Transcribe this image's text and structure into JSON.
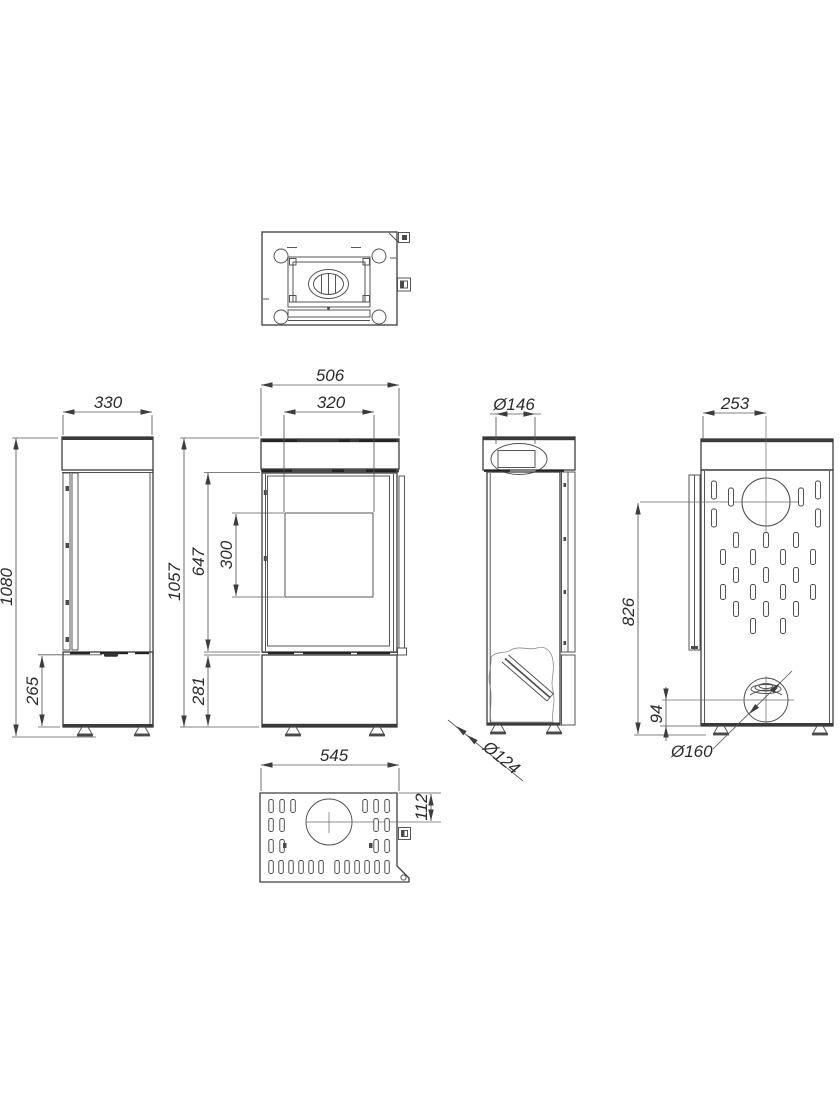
{
  "drawing": {
    "dimensions": {
      "front": {
        "width": "506",
        "glass_width": "320",
        "overall_height": "1057",
        "firebox_height": "647",
        "glass_height": "300",
        "base_height": "281"
      },
      "left_side": {
        "depth": "330",
        "overall_height": "1080",
        "handle_height": "265"
      },
      "right_side": {
        "flue_diameter": "Ø146",
        "air_inlet_diameter": "Ø124"
      },
      "back": {
        "flue_offset": "253",
        "flue_center_height": "826",
        "inlet_center_height": "94",
        "inlet_diameter": "Ø160"
      },
      "bottom": {
        "depth": "545",
        "flue_center_offset": "112"
      }
    }
  }
}
